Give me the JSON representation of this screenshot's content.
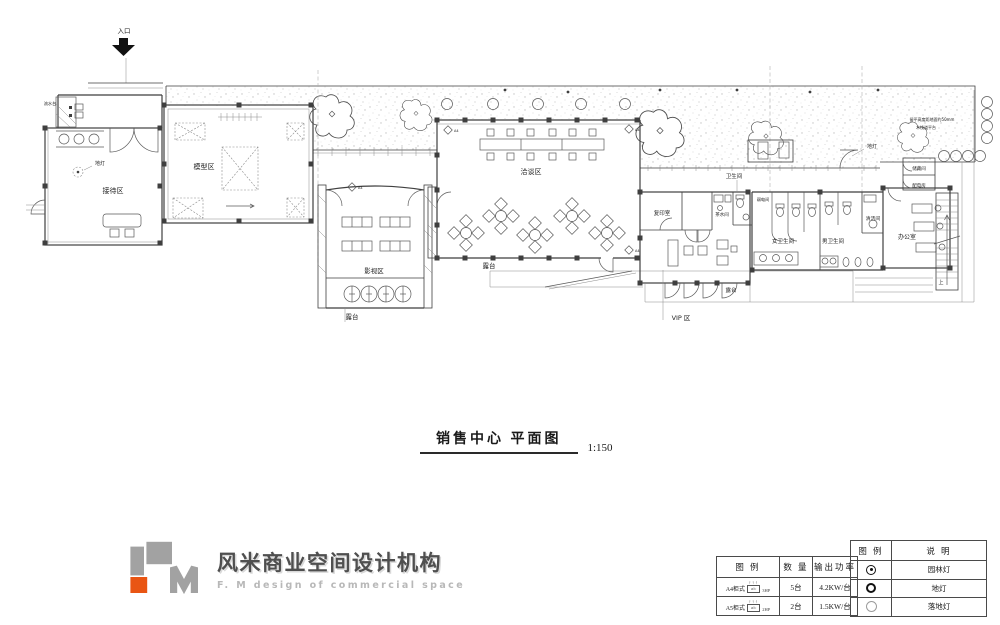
{
  "plan": {
    "labels": {
      "entrance": "入口",
      "sink": "流水台",
      "lamp": "地灯",
      "reception": "接待区",
      "model": "模型区",
      "video": "影视区",
      "terrace": "露台",
      "lounge": "洽谈区",
      "toilet": "卫生间",
      "copy_room": "复印室",
      "tea_room": "茶水间",
      "weak_power": "弱电间",
      "women_toilet": "女卫生间",
      "men_toilet": "男卫生间",
      "cleaning": "清洁间",
      "office": "办公室",
      "storage": "储藏间",
      "power_room": "配电房",
      "vip": "VIP 区",
      "stairs_up": "上",
      "marker": "A4",
      "note1": "留平高度距地面约50mm",
      "note2": "木栈道平台"
    }
  },
  "title": {
    "text": "销售中心 平面图",
    "scale": "1:150"
  },
  "logo": {
    "cn": "风米商业空间设计机构",
    "en": "F. M design of commercial space",
    "orange": "#e95513",
    "gray": "#a2a2a2"
  },
  "ac_table": {
    "headers": {
      "legend": "图 例",
      "qty": "数 量",
      "power": "输出功率"
    },
    "rows": [
      {
        "model": "A4柜式",
        "unit": "a/c",
        "hp": "3HP",
        "qty": "5台",
        "power": "4.2KW/台"
      },
      {
        "model": "A5柜式",
        "unit": "a/c",
        "hp": "2HP",
        "qty": "2台",
        "power": "1.5KW/台"
      }
    ]
  },
  "legend_table": {
    "headers": {
      "legend": "图 例",
      "desc": "说 明"
    },
    "rows": [
      {
        "symbol": "garden-light",
        "label": "园林灯"
      },
      {
        "symbol": "ground-light",
        "label": "地灯"
      },
      {
        "symbol": "floor-light",
        "label": "落地灯"
      }
    ]
  }
}
